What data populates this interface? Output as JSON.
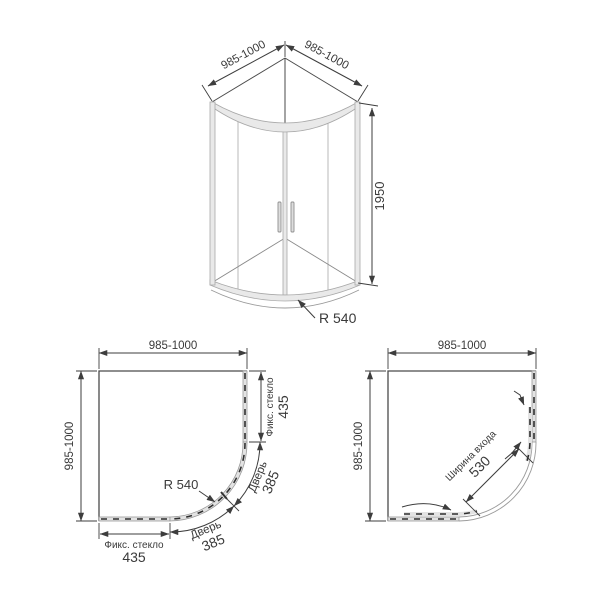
{
  "front_view": {
    "dim_width_left": "985-1000",
    "dim_width_right": "985-1000",
    "dim_height": "1950",
    "dim_radius": "R 540"
  },
  "plan_closed": {
    "dim_width": "985-1000",
    "dim_depth": "985-1000",
    "dim_radius": "R 540",
    "fixed_glass_side": {
      "label": "Фикс. стекло",
      "value": "435"
    },
    "fixed_glass_bottom": {
      "label": "Фикс. стекло",
      "value": "435"
    },
    "door_upper": {
      "label": "Дверь",
      "value": "385"
    },
    "door_lower": {
      "label": "Дверь",
      "value": "385"
    }
  },
  "plan_open": {
    "dim_width": "985-1000",
    "dim_depth": "985-1000",
    "entrance": {
      "label": "Ширина входа",
      "value": "530"
    }
  }
}
